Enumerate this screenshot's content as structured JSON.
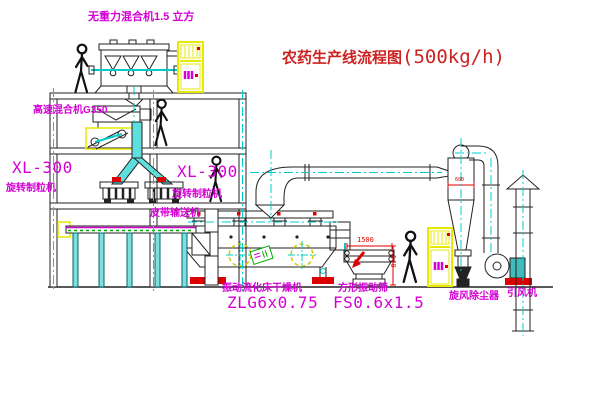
{
  "title": {
    "text": "农药生产线流程图",
    "capacity": "(500kg/h)"
  },
  "equipment_labels": {
    "gravity_mixer": "无重力混合机1.5 立方",
    "high_speed_mixer": "高速混合机G350",
    "granulator_left_model": "XL-300",
    "granulator_left_name": "旋转制粒机",
    "granulator_right_model": "XL-300",
    "granulator_right_name": "旋转制粒机",
    "belt_conveyor": "皮带输送机",
    "dryer_name": "振动流化床干燥机",
    "dryer_model": "ZLG6x0.75",
    "screen_name": "方形振动筛",
    "screen_model": "FS0.6x1.5",
    "cyclone": "旋风除尘器",
    "fan": "引风机"
  },
  "dimensions": {
    "screen_length": "1500",
    "screen_height": "540",
    "cyclone_diameter": "600"
  },
  "colors": {
    "label_magenta": "#d400d4",
    "title_red": "#cc2222",
    "centerline_cyan": "#00cccc",
    "cabinet_yellow": "#e8e800",
    "accent_red": "#dd0000",
    "chute_cyan_fill": "#5fdede",
    "motor_teal": "#44bbbb",
    "belt_green": "#00aa00"
  }
}
